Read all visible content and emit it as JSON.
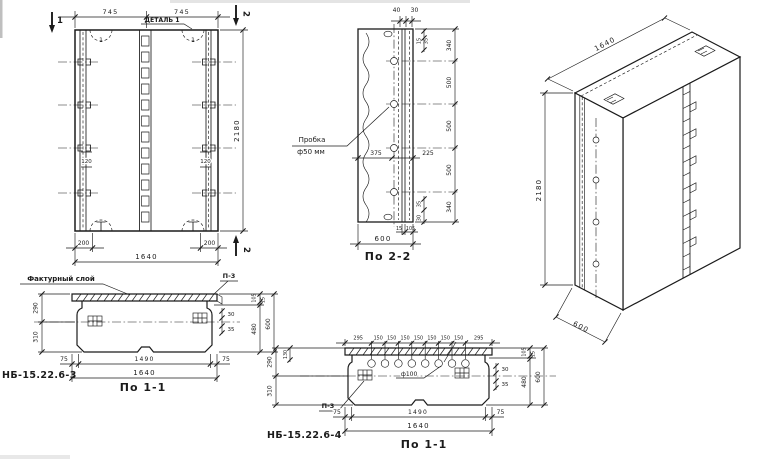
{
  "drawing": {
    "front": {
      "dim_top_left": "745",
      "dim_top_right": "745",
      "detail_label": "ДЕТАЛЬ 1",
      "detail_bubble_left": "1",
      "detail_bubble_right": "1",
      "section_mark_left": "1",
      "section_mark_right_top": "2",
      "section_mark_right_bottom": "2",
      "dim_height": "2180",
      "dim_rib_left": "120",
      "dim_rib_right": "120",
      "dim_bottom_left": "200",
      "dim_bottom_right": "200",
      "dim_width": "1640"
    },
    "section22": {
      "caption": "По 2-2",
      "plug_line1": "Пробка",
      "plug_line2": "ф50 мм",
      "dim_top_40": "40",
      "dim_top_30": "30",
      "dim_tr_15": "15",
      "dim_tr_35": "35",
      "dims_right": [
        "340",
        "500",
        "500",
        "500",
        "340"
      ],
      "dim_br_35": "35",
      "dim_br_30": "30",
      "dim_mid_375": "375",
      "dim_mid_225": "225",
      "dim_b_15": "15",
      "dim_b_105": "105",
      "dim_depth": "600"
    },
    "plan3": {
      "mark": "НБ-15.22.6-3",
      "caption": "По 1-1",
      "facing_label": "Фактурный слой",
      "detail_ref": "П-3",
      "dim_left_290": "290",
      "dim_left_310": "310",
      "dim_r_30": "30",
      "dim_r_35": "35",
      "dim_rv_105": "105",
      "dim_rv_15": "15",
      "dim_rv_480": "480",
      "dim_rv_600": "600",
      "dim_b_75l": "75",
      "dim_b_1490": "1490",
      "dim_b_75r": "75",
      "dim_width": "1640"
    },
    "plan4": {
      "mark": "НБ-15.22.6-4",
      "caption": "По 1-1",
      "detail_ref": "П-3",
      "hole_label": "ф100",
      "dims_top": [
        "295",
        "150",
        "150",
        "150",
        "150",
        "150",
        "150",
        "150",
        "295"
      ],
      "dim_left_130": "130",
      "dim_left_290": "290",
      "dim_left_310": "310",
      "dim_r_30": "30",
      "dim_r_35": "35",
      "dim_rv_105": "105",
      "dim_rv_15": "15",
      "dim_rv_480": "480",
      "dim_rv_600": "600",
      "dim_b_75l": "75",
      "dim_b_1490": "1490",
      "dim_b_75r": "75",
      "dim_width": "1640"
    },
    "iso": {
      "dim_width": "1640",
      "dim_height": "2180",
      "dim_depth": "600"
    }
  }
}
